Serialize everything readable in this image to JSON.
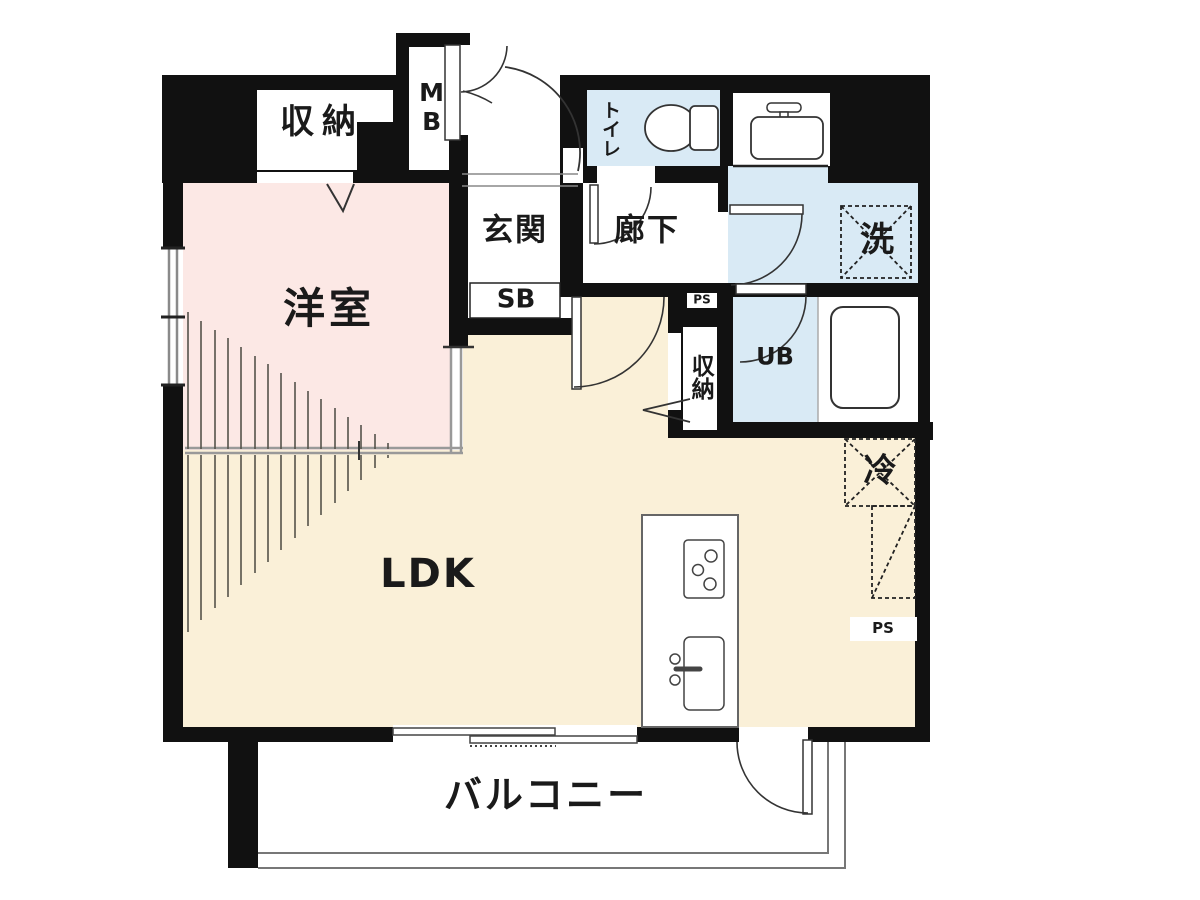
{
  "floorplan": {
    "rooms": {
      "western_room": "洋室",
      "ldk": "LDK",
      "balcony": "バルコニー",
      "entrance": "玄関",
      "hallway": "廊下",
      "toilet": "トイレ"
    },
    "labels": {
      "storage_top": "収納",
      "storage_mid": "収納",
      "meter_box": "MB",
      "shoe_box": "SB",
      "unit_bath": "UB",
      "washer": "洗",
      "refrigerator": "冷",
      "pipe_space_1": "PS",
      "pipe_space_2": "PS"
    },
    "colors": {
      "wall": "#111111",
      "western_room_fill": "#fce8e5",
      "ldk_fill": "#faf0d8",
      "wet_area_fill": "#d9eaf5",
      "fixture_stroke": "#333333",
      "track_gray": "#999999"
    }
  }
}
